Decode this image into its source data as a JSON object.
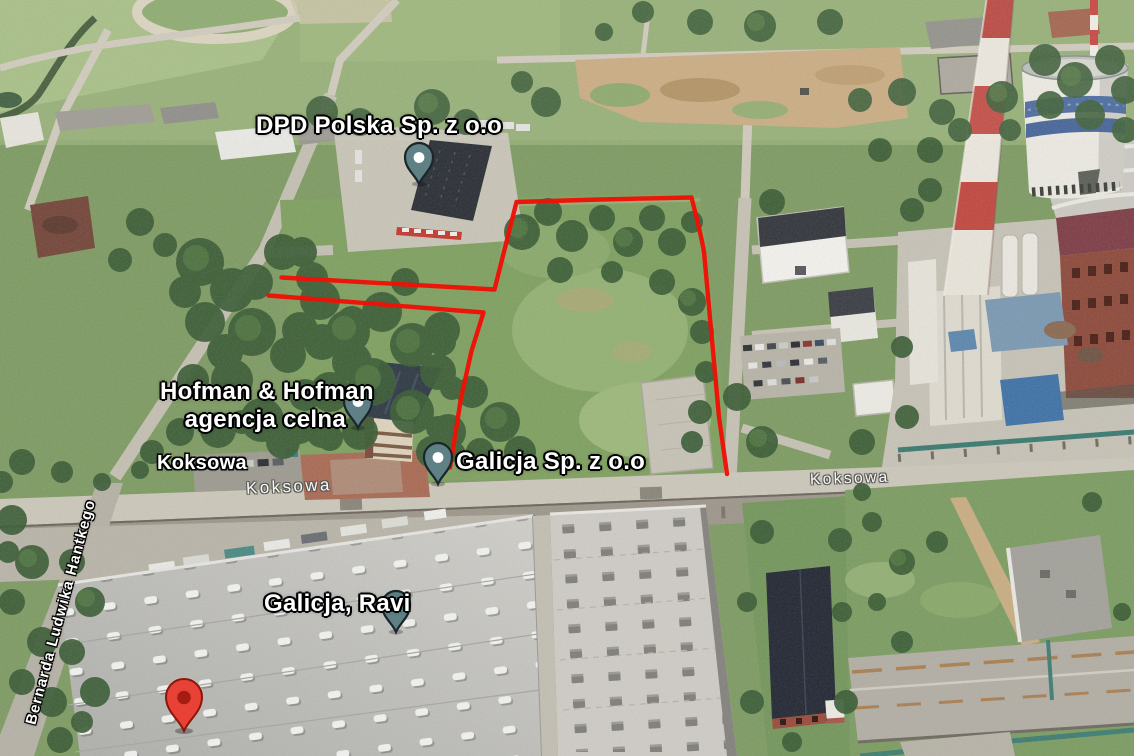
{
  "map": {
    "view_type": "3D satellite aerial view",
    "places": [
      {
        "label": "DPD Polska Sp. z o.o",
        "marker": "teal-pin"
      },
      {
        "label": "Hofman & Hofman",
        "label_line2": "agencja celna",
        "marker": "teal-pin"
      },
      {
        "label": "Galicja Sp. z o.o",
        "marker": "teal-pin"
      },
      {
        "label": "Galicja, Ravi",
        "marker": "teal-pin"
      }
    ],
    "street_labels": {
      "koksowa_primary": "Koksowa",
      "koksowa_on_road_left": "Koksowa",
      "koksowa_on_road_right": "Koksowa",
      "hantkego": "Bernarda Ludwika Hantkego"
    },
    "markers": {
      "dropped_pin": {
        "type": "red-pin"
      }
    },
    "boundary": {
      "color": "#f01107",
      "description": "red outlined plot boundary"
    },
    "colors": {
      "boundary_red": "#f01107",
      "pin_teal": "#5f8084",
      "pin_red": "#e84135",
      "pin_dot_white": "#ffffff",
      "pin_dot_dark_red": "#a51c10",
      "label_text": "#ffffff",
      "label_halo": "#000000"
    }
  }
}
